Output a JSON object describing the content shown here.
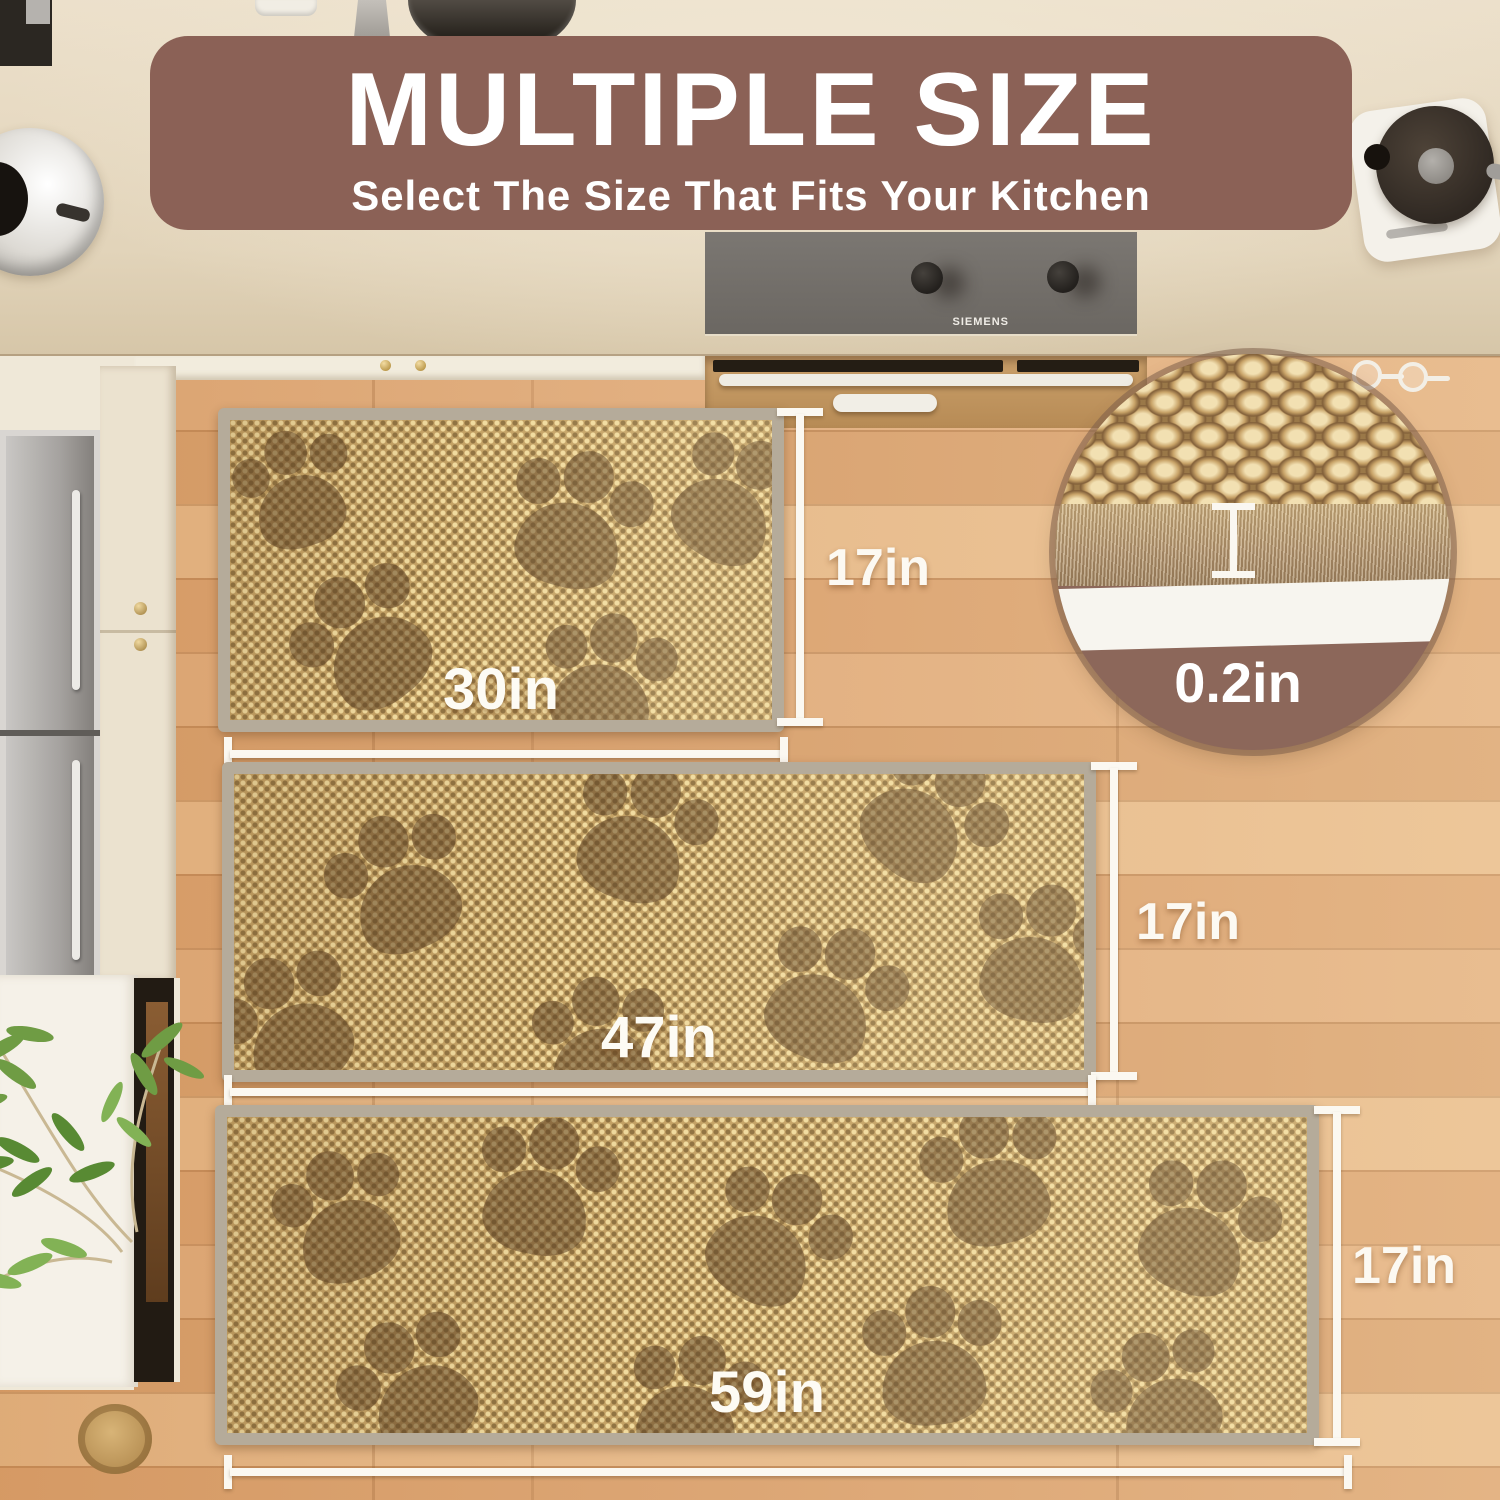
{
  "banner": {
    "title": "MULTIPLE SIZE",
    "subtitle": "Select The Size That Fits Your Kitchen"
  },
  "rugs": [
    {
      "name": "small rug",
      "size_label": "30in",
      "height_label": "17in"
    },
    {
      "name": "medium rug",
      "size_label": "47in",
      "height_label": "17in"
    },
    {
      "name": "large rug",
      "size_label": "59in",
      "height_label": "17in"
    }
  ],
  "inset": {
    "thickness_label": "0.2in"
  },
  "stove": {
    "brand": "SIEMENS"
  },
  "colors": {
    "banner_bg": "#8b6156",
    "banner_text": "#ffffff",
    "measurement_white": "#fbf8f1",
    "rug_base": "#c4a265",
    "rug_border": "#b5ab9a",
    "paw_print": "rgba(92,66,36,0.52)",
    "floor_wood": "#e0ac7c",
    "countertop": "#e8dcc4",
    "inset_brown": "#8c675a"
  }
}
